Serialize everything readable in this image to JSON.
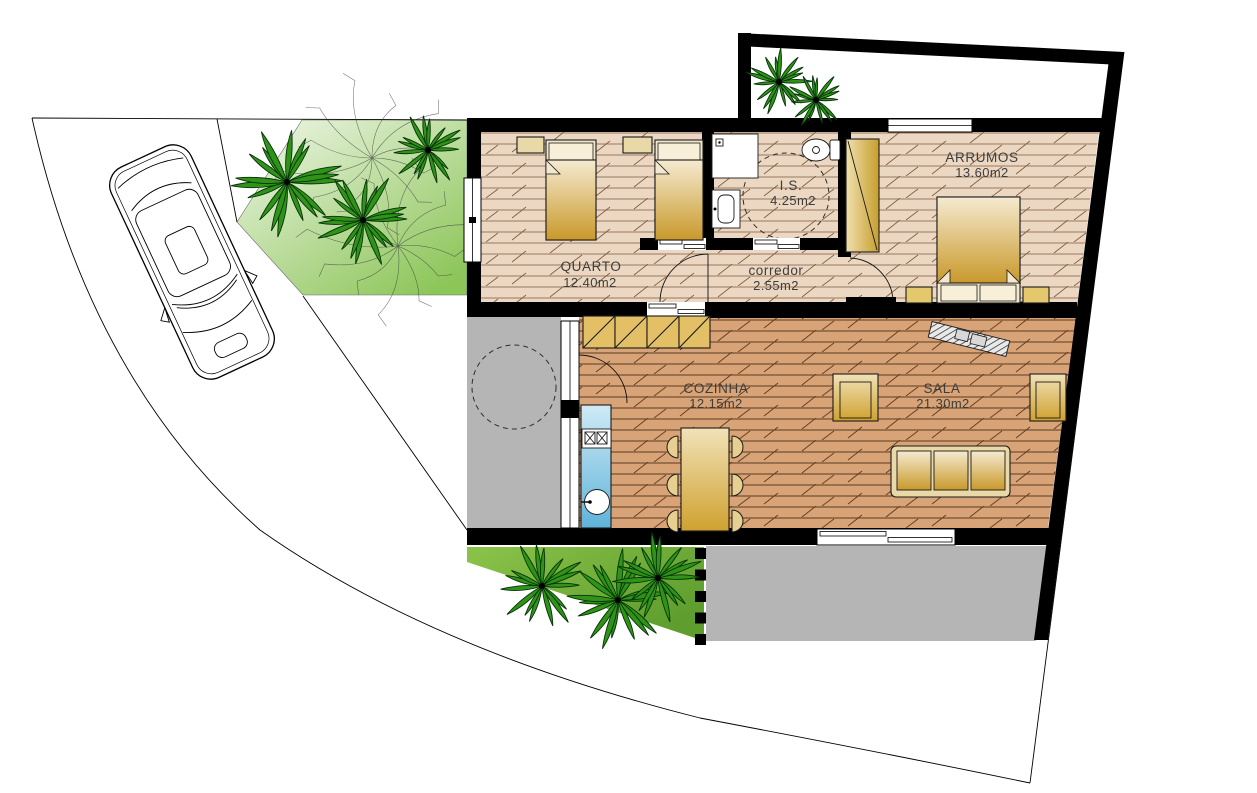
{
  "plan": {
    "rooms": [
      {
        "id": "quarto",
        "label": "QUARTO",
        "area": "12.40m2"
      },
      {
        "id": "is",
        "label": "I.S.",
        "area": "4.25m2"
      },
      {
        "id": "corredor",
        "label": "corredor",
        "area": "2.55m2"
      },
      {
        "id": "arrumos",
        "label": "ARRUMOS",
        "area": "13.60m2"
      },
      {
        "id": "cozinha",
        "label": "COZINHA",
        "area": "12.15m2"
      },
      {
        "id": "sala",
        "label": "SALA",
        "area": "21.30m2"
      }
    ],
    "colors": {
      "wall": "#000000",
      "floor_light": "#ecd8c2",
      "floor_dark": "#d8a377",
      "lawn_light": "#f1f7ea",
      "lawn": "#8cc558",
      "lawn_dark": "#5f9e2e",
      "patio_gray": "#b5b5b5",
      "furniture_gold_light": "#f5ead0",
      "furniture_gold": "#c9992b",
      "counter_blue_light": "#cfeaf6",
      "counter_blue": "#5fb3d9",
      "palm_green": "#2f9318"
    }
  }
}
